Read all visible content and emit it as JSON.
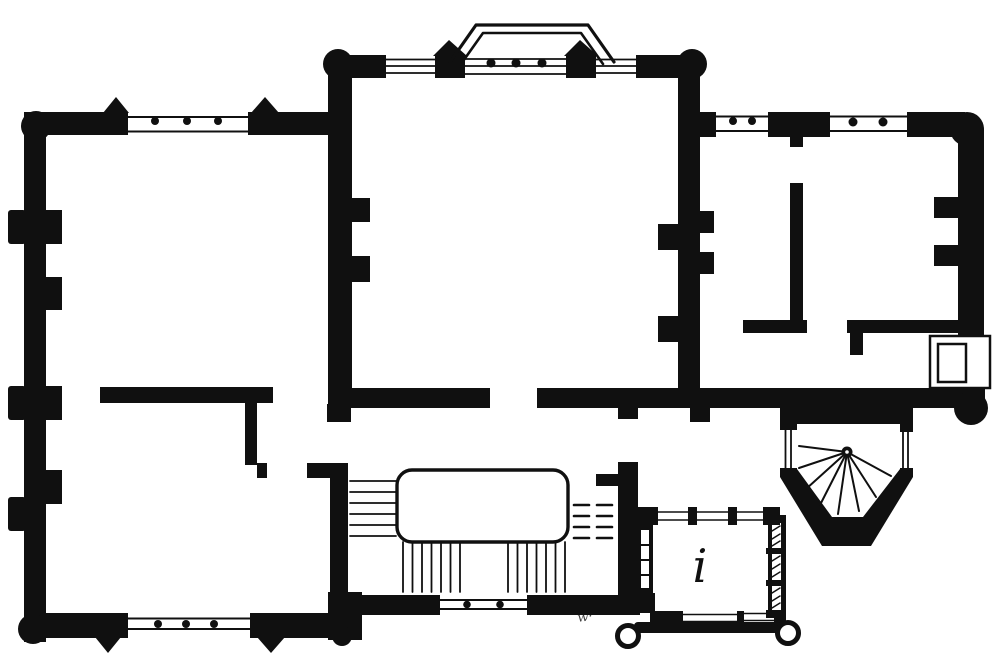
{
  "drawing": {
    "type": "floor-plan-engraving",
    "ink": "#101010",
    "paper": "#ffffff",
    "labels": {
      "porch_room": "i",
      "plate_mark": "w·"
    }
  }
}
